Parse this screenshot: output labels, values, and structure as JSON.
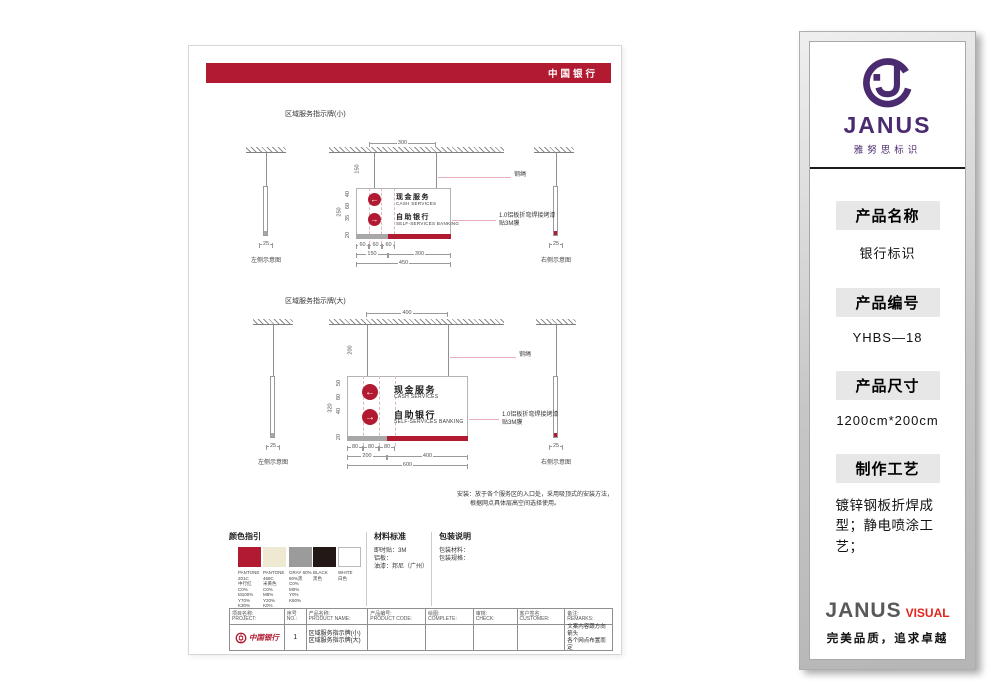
{
  "colors": {
    "boc_red": "#B11A31",
    "janus_purple": "#4B2B6F",
    "visual_red": "#E2241D",
    "strip_gray": "#A8A8A8"
  },
  "sheet": {
    "header": {
      "title": "中国银行"
    },
    "drawings": [
      {
        "title": "区域服务指示牌(小)",
        "top_width": "300",
        "wire_height": "150",
        "overall_height": "250",
        "row_dims": [
          "40",
          "60",
          "35"
        ],
        "strip_height": "20",
        "seg_dims": [
          "60",
          "60",
          "60"
        ],
        "split_dims": [
          "150",
          "300"
        ],
        "total_width": "450",
        "side_width": "25",
        "left_view": "左侧示意图",
        "right_view": "右侧示意图",
        "wire_note": "钢绳",
        "panel_note1": "1.0铝板折弯焊接烤漆",
        "panel_note2": "贴3M膜",
        "rows": [
          {
            "arrow": "←",
            "zh": "现金服务",
            "en": "CASH SERVICES"
          },
          {
            "arrow": "→",
            "zh": "自助银行",
            "en": "SELF-SERVICES BANKING"
          }
        ]
      },
      {
        "title": "区域服务指示牌(大)",
        "top_width": "400",
        "wire_height": "200",
        "overall_height": "320",
        "row_dims": [
          "50",
          "80",
          "40"
        ],
        "strip_height": "20",
        "seg_dims": [
          "80",
          "80",
          "80"
        ],
        "split_dims": [
          "200",
          "400"
        ],
        "total_width": "600",
        "side_width": "25",
        "left_view": "左侧示意图",
        "right_view": "右侧示意图",
        "wire_note": "钢绳",
        "panel_note1": "1.0铝板折弯焊接烤漆",
        "panel_note2": "贴3M膜",
        "rows": [
          {
            "arrow": "←",
            "zh": "现金服务",
            "en": "CASH SERVICES"
          },
          {
            "arrow": "→",
            "zh": "自助银行",
            "en": "SELF-SERVICES BANKING"
          }
        ]
      }
    ],
    "install_note": [
      "安装：放于各个服务区的入口处，采用吸顶式的安装方法，",
      "根据网点具体层高空间选择使用。"
    ],
    "color_guide": {
      "title": "颜色指引",
      "swatches": [
        {
          "hex": "#B11A31",
          "lines": [
            "PANTONE",
            "201C",
            "中行红",
            "C0%",
            "M100%",
            "Y70%",
            "K30%"
          ]
        },
        {
          "hex": "#EFE9D2",
          "lines": [
            "PANTONE",
            "468C",
            "米黄色",
            "C0%",
            "M8%",
            "Y20%",
            "K0%"
          ]
        },
        {
          "hex": "#9B9B9B",
          "lines": [
            "GRAY 60%",
            "60%黑",
            "C0%",
            "M0%",
            "Y0%",
            "K60%"
          ]
        },
        {
          "hex": "#231815",
          "lines": [
            "BLACK",
            "黑色"
          ]
        },
        {
          "hex": "#FFFFFF",
          "lines": [
            "WHITE",
            "白色"
          ]
        }
      ]
    },
    "material": {
      "title": "材料标准",
      "lines": [
        "即时贴：3M",
        "铝板：",
        "油漆：邦尼（广州）"
      ]
    },
    "packing": {
      "title": "包装说明",
      "lines": [
        "包装材料：",
        "包装规格："
      ]
    },
    "title_block": {
      "cols": [
        {
          "zh": "项目名称:",
          "en": "PROJECT:"
        },
        {
          "zh": "序号",
          "en": "NO.:"
        },
        {
          "zh": "产品名称:",
          "en": "PRODUCT NAME:"
        },
        {
          "zh": "产品编号:",
          "en": "PRODUCT CODE:"
        },
        {
          "zh": "绘图:",
          "en": "COMPLETE:"
        },
        {
          "zh": "审核:",
          "en": "CHECK:"
        },
        {
          "zh": "客户签名:",
          "en": "CUSTOMER:"
        },
        {
          "zh": "备注:",
          "en": "REMARKS:"
        }
      ],
      "project": "中国银行",
      "no": "1",
      "product_names": [
        "区域服务指示牌(小)",
        "区域服务指示牌(大)"
      ],
      "remarks": [
        "文案内容跟方向箭头",
        "各个网点布置而定"
      ]
    }
  },
  "sidebar": {
    "logo": {
      "brand": "JANUS",
      "sub": "雅努思标识"
    },
    "sections": [
      {
        "label": "产品名称",
        "value": "银行标识"
      },
      {
        "label": "产品编号",
        "value": "YHBS—18"
      },
      {
        "label": "产品尺寸",
        "value": "1200cm*200cm"
      },
      {
        "label": "制作工艺",
        "value": "镀锌钢板折焊成型；静电喷涂工艺；"
      }
    ],
    "footer": {
      "brand": "JANUS",
      "brand2": "VISUAL",
      "slogan": "完美品质，追求卓越"
    }
  }
}
